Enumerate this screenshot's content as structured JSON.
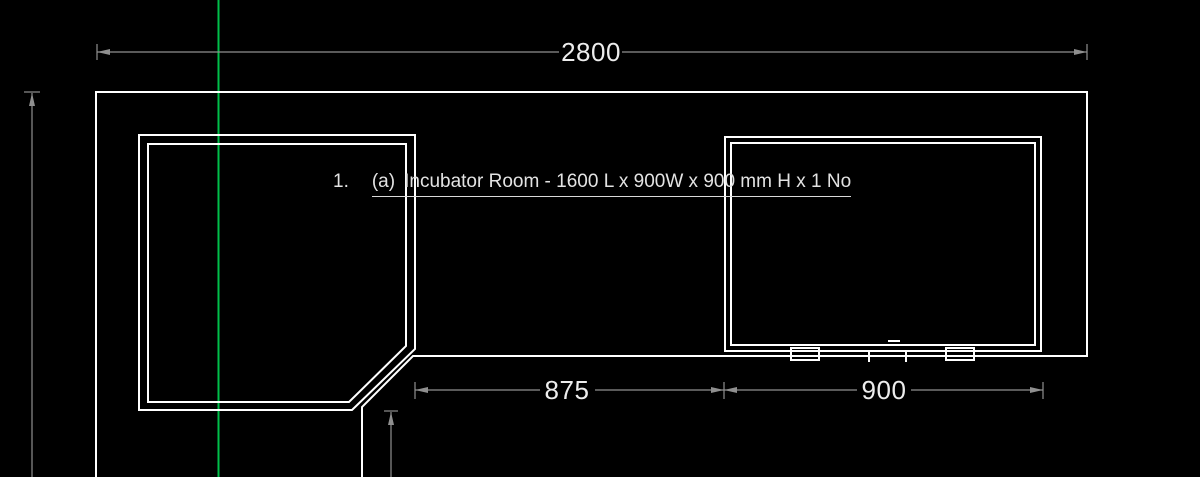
{
  "drawing": {
    "annotation": {
      "number": "1.",
      "index": "(a)",
      "text": "Incubator Room - 1600 L x 900W x 900 mm H x 1 No"
    },
    "dimensions": {
      "overall_width": "2800",
      "left_span": "875",
      "right_span": "900"
    },
    "colors": {
      "background": "#000000",
      "geometry": "#ffffff",
      "dimension": "#8f8f8f",
      "dimension_text": "#ededed",
      "note_text": "#e3e3e3",
      "guide": "#00bf4a"
    }
  }
}
